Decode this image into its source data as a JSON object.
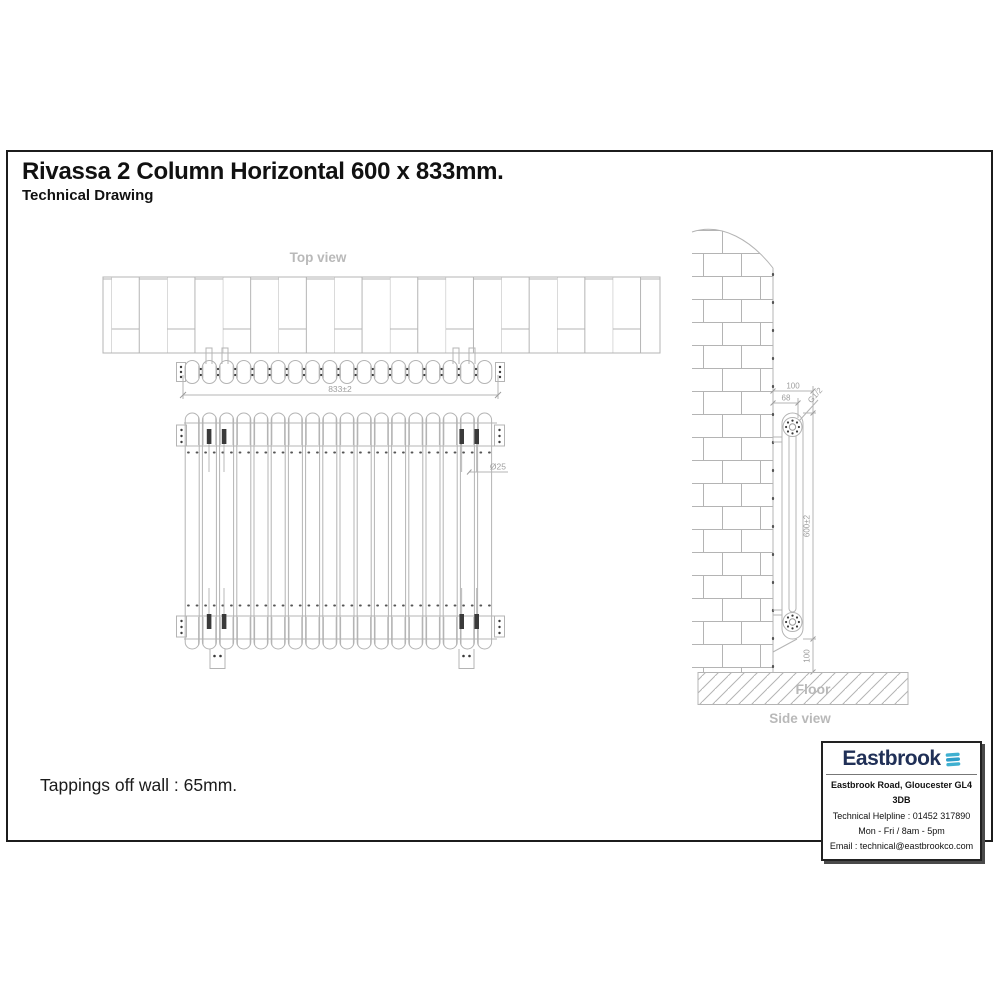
{
  "page": {
    "title": "Rivassa 2 Column Horizontal 600 x 833mm.",
    "subtitle": "Technical Drawing",
    "tappings_note": "Tappings off wall : 65mm."
  },
  "views": {
    "top_label": "Top view",
    "side_label": "Side view",
    "floor_label": "Floor"
  },
  "dimensions": {
    "width": "833±2",
    "column_diameter": "Ø25",
    "wall_to_front": "100",
    "wall_to_tapping": "68",
    "thread": "G1/2",
    "height": "600±2",
    "floor_clearance": "100"
  },
  "brand": {
    "name": "Eastbrook",
    "logo_icon": "waves-icon",
    "address": "Eastbrook Road, Gloucester GL4 3DB",
    "helpline": "Technical Helpline : 01452 317890",
    "hours": "Mon - Fri / 8am - 5pm",
    "email": "Email : technical@eastbrookco.com",
    "navy": "#203057",
    "teal": "#3fb0d0"
  },
  "colors": {
    "line": "#b4b4b4",
    "label": "#b9b9b9",
    "dim_text": "#9e9e9e",
    "dark_detail": "#3a3a3a"
  }
}
